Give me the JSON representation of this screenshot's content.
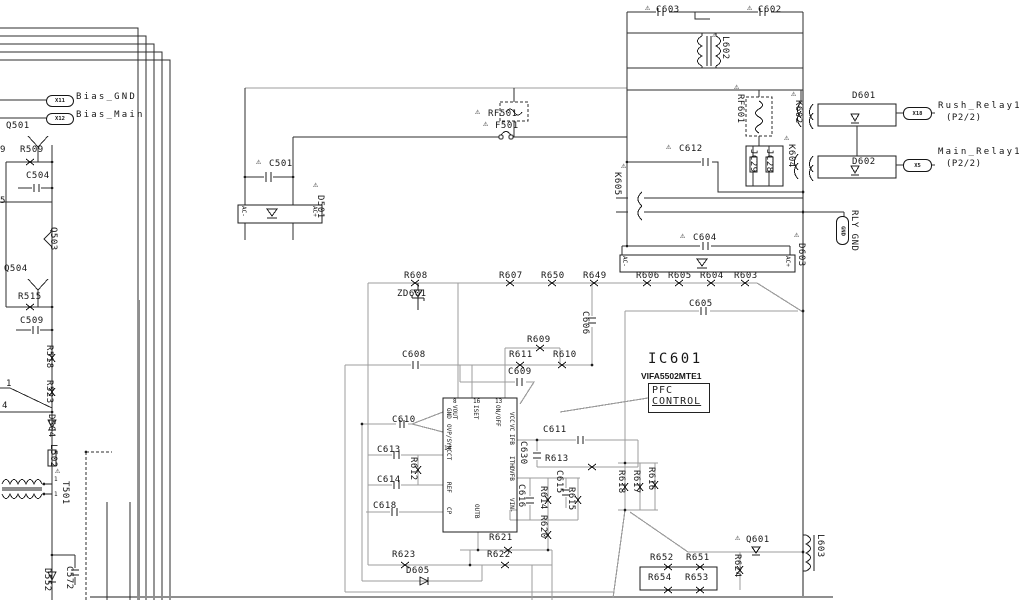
{
  "icons": {
    "warning": "⚠"
  },
  "labels": {
    "c603": "C603",
    "c602": "C602",
    "l602": "L602",
    "rf601": "RF601",
    "k602": "K602",
    "d601": "D601",
    "rush_relay": "Rush_Relay1",
    "rush_page": "(P2/2)",
    "rush_pin": "X18",
    "d602": "D602",
    "main_relay": "Main_Relay1",
    "main_page": "(P2/2)",
    "main_pin": "X5",
    "c612": "C612",
    "k605": "K605",
    "jc29": "JC29",
    "jc28": "JC28",
    "k604": "K604",
    "c604": "C604",
    "d603": "D603",
    "ac_minus_b": "AC-",
    "ac_plus_b": "AC+",
    "rly_gnd": "RLY GND",
    "gnd_pin": "GND",
    "x11": "X11",
    "bias_gnd": "Bias_GND",
    "x12": "X12",
    "bias_main": "Bias_Main",
    "q501": "Q501",
    "r509": "R509",
    "c504": "C504",
    "q503": "Q503",
    "q504": "Q504",
    "r515": "R515",
    "c509": "C509",
    "r518": "R518",
    "r523": "R523",
    "d504": "D504",
    "l502": "L502",
    "t501": "T501",
    "t501_pin_a": "1",
    "t501_pin_b": "1",
    "frag_9": "9",
    "frag_5": "5",
    "frag_1": "1",
    "frag_4": "4",
    "d552": "D552",
    "c572": "C572",
    "f501": "F501",
    "rf501": "RF501",
    "c501": "C501",
    "d501": "D501",
    "ac_minus_a": "AC-",
    "ac_plus_a": "AC+",
    "r608": "R608",
    "zd601": "ZD601",
    "r607": "R607",
    "r650": "R650",
    "r649": "R649",
    "r606": "R606",
    "r605": "R605",
    "r604": "R604",
    "r603": "R603",
    "c605": "C605",
    "c606": "C606",
    "c608": "C608",
    "r609": "R609",
    "r611": "R611",
    "r610": "R610",
    "c609": "C609",
    "c610": "C610",
    "ic_ref": "IC601",
    "ic_part": "VIFA5502MTE1",
    "ic_func1": "PFC",
    "ic_func2": "CONTROL",
    "pin8": "8",
    "pin16": "16",
    "pin13": "13",
    "pin14": "14",
    "pin_vout": "VOUT",
    "pin_iset": "ISET",
    "pin_onoff": "ON/OFF",
    "pin_gnd": "GND",
    "pin_ovpsync": "OVP/SYNC",
    "pin_ct": "CT",
    "pin_ref": "REF",
    "pin_cp": "CP",
    "pin_vcc": "VCC",
    "pin_vc": "VC",
    "pin_ifb": "IFB",
    "pin_ithd": "ITHD",
    "pin_vfb": "VFB",
    "pin_vinm": "VIN-",
    "pin_outb": "OUTB",
    "c613": "C613",
    "r612": "R612",
    "c614": "C614",
    "c618": "C618",
    "c611": "C611",
    "c630": "C630",
    "r613": "R613",
    "c616": "C616",
    "r614": "R614",
    "c615": "C615",
    "r615": "R615",
    "r620": "R620",
    "r621": "R621",
    "r622": "R622",
    "r623": "R623",
    "d605": "D605",
    "r616": "R616",
    "r617": "R617",
    "r618": "R618",
    "q601": "Q601",
    "r624": "R624",
    "l603": "L603",
    "r652": "R652",
    "r651": "R651",
    "r654": "R654",
    "r653": "R653"
  }
}
